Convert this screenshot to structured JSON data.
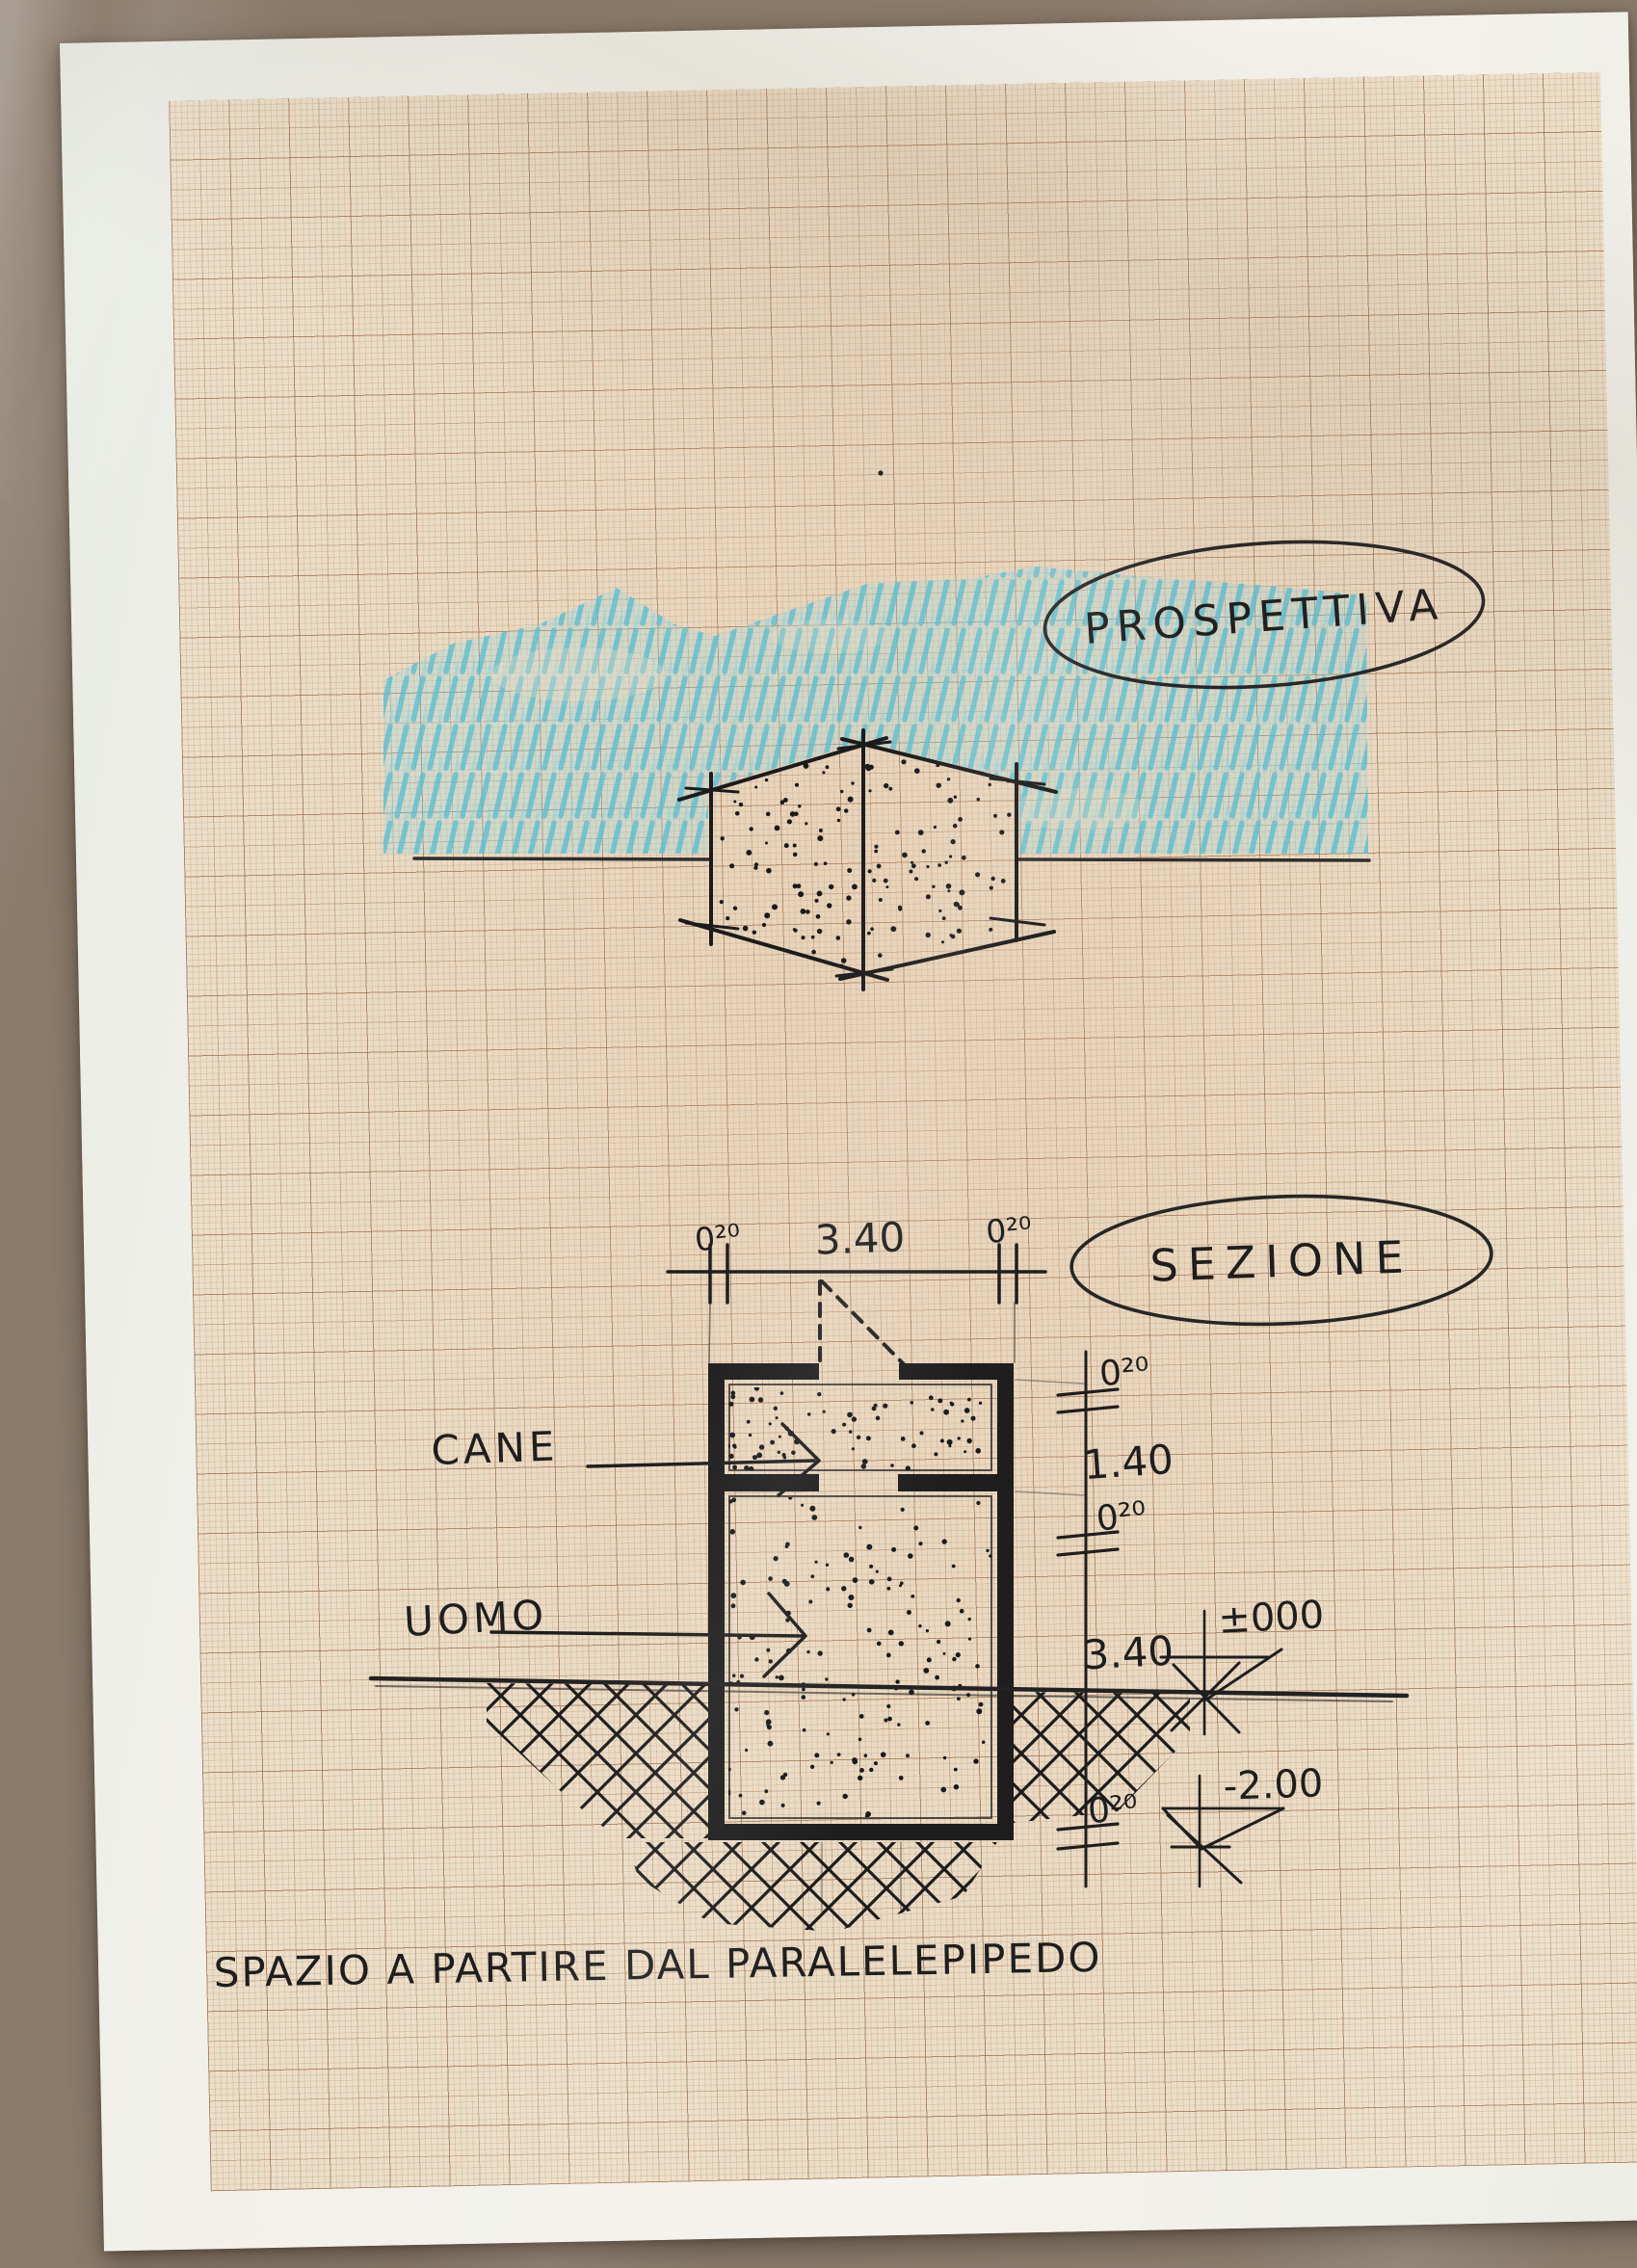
{
  "photo": {
    "surface_color": "#8a7b6b",
    "sheet_color": "#f1f1ea",
    "paper_color": "#ecdfc9",
    "ink_color": "#1e1e1e",
    "marker_blue": "#54bfd2"
  },
  "perspective": {
    "title": "PROSPETTIVA"
  },
  "section": {
    "title": "SEZIONE",
    "label_cane": "CANE",
    "label_uomo": "UOMO",
    "dims_top": {
      "left": "0²⁰",
      "middle": "3.40",
      "right": "0²⁰"
    },
    "dims_right": {
      "wall_top": "0²⁰",
      "cane_height": "1.40",
      "wall_mid": "0²⁰",
      "uomo_height": "3.40",
      "wall_bottom": "0²⁰"
    },
    "levels": {
      "ground": "±000",
      "bottom": "-2.00"
    }
  },
  "caption": "SPAZIO A PARTIRE DAL PARALELEPIPEDO"
}
